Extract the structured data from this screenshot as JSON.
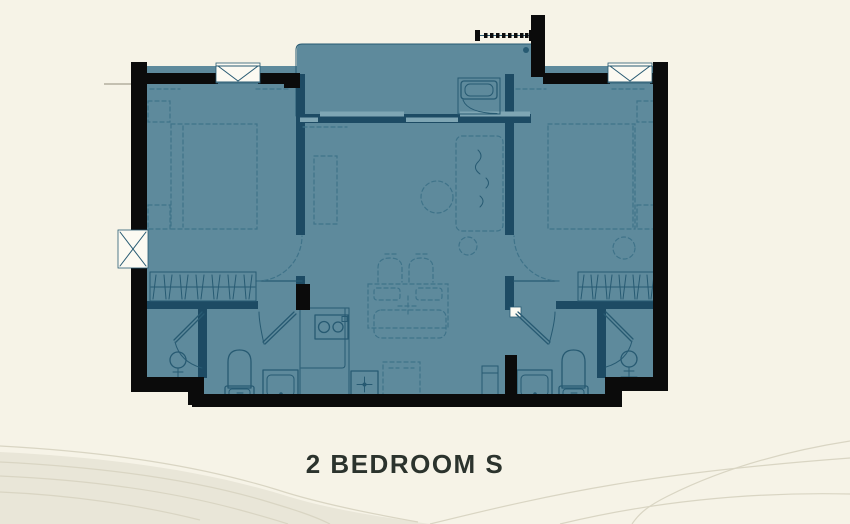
{
  "title": {
    "label": "2 BEDROOM S"
  },
  "palette": {
    "paper": "#f6f3e7",
    "floor": "#5e8a9c",
    "floor_light": "#7fa6b4",
    "wall_dark": "#1d4b64",
    "wall_black": "#0b0b0b",
    "line": "#275a72",
    "line_soft": "#3f7389",
    "white": "#fcfaf2",
    "sill": "#b3af9f",
    "wave_fill": "#e9e6d8",
    "wave_line": "#d9d5c3",
    "title_text": "#2b332d"
  },
  "icons": {
    "window": "window-icon",
    "ac_unit": "ac-window-icon",
    "louver": "ac-louver-icon",
    "sliding_door": "sliding-door-icon",
    "door": "door-swing-icon",
    "bed": "bed-icon",
    "wardrobe": "wardrobe-icon",
    "toilet": "toilet-icon",
    "sink_vanity": "sink-icon",
    "shower": "shower-icon",
    "washer": "washer-icon",
    "fridge": "fridge-icon",
    "cooktop": "cooktop-icon",
    "kitchen_sink": "kitchen-sink-icon",
    "dining_table": "dining-table-icon",
    "chair": "chair-icon",
    "sofa": "sofa-icon",
    "rug": "rug-icon",
    "tv_console": "tv-console-icon",
    "floor_drain": "floor-drain-icon"
  }
}
